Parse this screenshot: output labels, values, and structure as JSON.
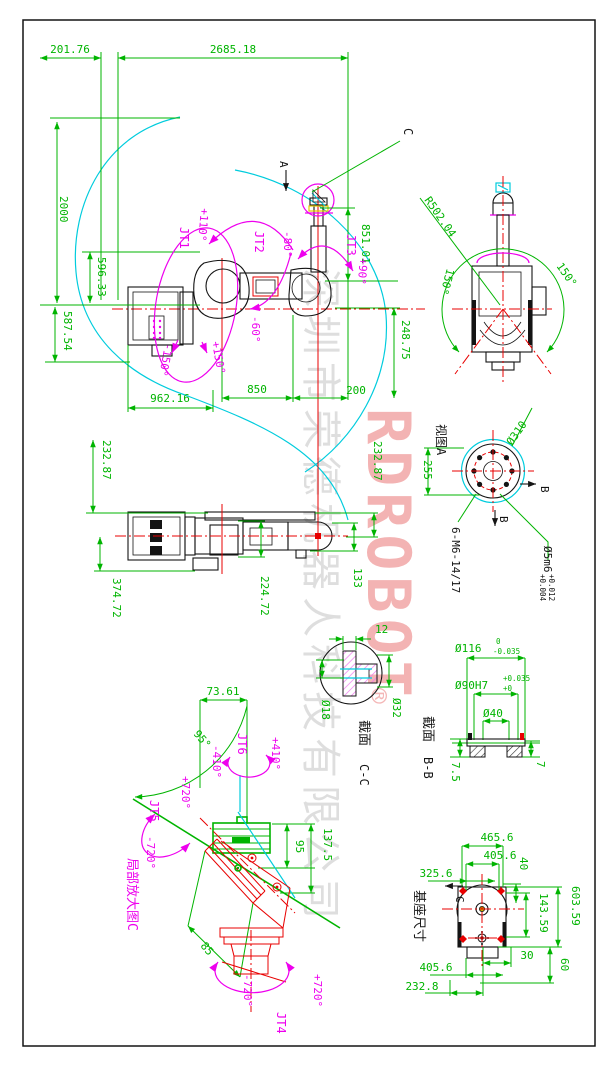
{
  "watermark": {
    "brand": "RDROBOT",
    "registered": "®",
    "company": "深圳市荣德机器人科技有限公司"
  },
  "main_view": {
    "dim_201": "201.76",
    "dim_2685": "2685.18",
    "dim_2000": "2000",
    "dim_596": "596.33",
    "dim_587": "587.54",
    "dim_962": "962.16",
    "dim_850": "850",
    "dim_200": "200",
    "dim_851": "851.01",
    "dim_248": "248.75",
    "label_a": "A",
    "label_c": "C",
    "jt1": "JT1",
    "jt1_min": "-150°",
    "jt1_max": "+150°",
    "jt2": "JT2",
    "jt2_max": "+110°",
    "jt2_min": "-60°",
    "jt3": "JT3",
    "jt3_min": "-80°",
    "jt3_max": "+90°"
  },
  "top_view": {
    "radius": "R502.04",
    "sweep_left": "150°",
    "sweep_right": "150°"
  },
  "view_a": {
    "title": "视图A",
    "flange_dia": "Ø310",
    "dim_255": "255",
    "section_mark": "B",
    "bolts": "6-M6-14/17",
    "pin": "Ø5m6",
    "pin_tol_upper": "+0.012",
    "pin_tol_lower": "+0.004"
  },
  "plan_view": {
    "dim_232_left": "232.87",
    "dim_374": "374.72",
    "dim_224": "224.72",
    "dim_133": "133",
    "dim_232_right": "232.87"
  },
  "section_cc": {
    "label": "截面",
    "name": "C-C",
    "dim_12": "12",
    "dim_18": "Ø18",
    "dim_32": "Ø32"
  },
  "section_bb": {
    "label": "截面",
    "name": "B-B",
    "dia_116": "Ø116",
    "dia_116_tol_upper": "0",
    "dia_116_tol_lower": "-0.035",
    "dia_90": "Ø90H7",
    "dia_90_tol_upper": "+0.035",
    "dia_90_tol_lower": "+0",
    "dia_40": "Ø40",
    "dim_7_5": "7.5",
    "dim_7": "7"
  },
  "detail_c": {
    "title": "局部放大图C",
    "dim_73": "73.61",
    "angle_95": "95°",
    "dim_95": "95",
    "dim_137": "137.5",
    "dim_85": "85",
    "jt4": "JT4",
    "jt4_max": "+720°",
    "jt4_min": "-720°",
    "jt5": "JT5",
    "jt5_max": "+720°",
    "jt5_min": "-720°",
    "jt6": "JT6",
    "jt6_max": "+410°",
    "jt6_min": "-410°"
  },
  "base_view": {
    "title": "基座尺寸",
    "label_c": "C",
    "dim_465": "465.6",
    "dim_405_top": "405.6",
    "dim_325": "325.6",
    "dim_40": "40",
    "dim_143": "143.59",
    "dim_603": "603.59",
    "dim_30": "30",
    "dim_60": "60",
    "dim_405_bottom": "405.6",
    "dim_232": "232.8"
  }
}
